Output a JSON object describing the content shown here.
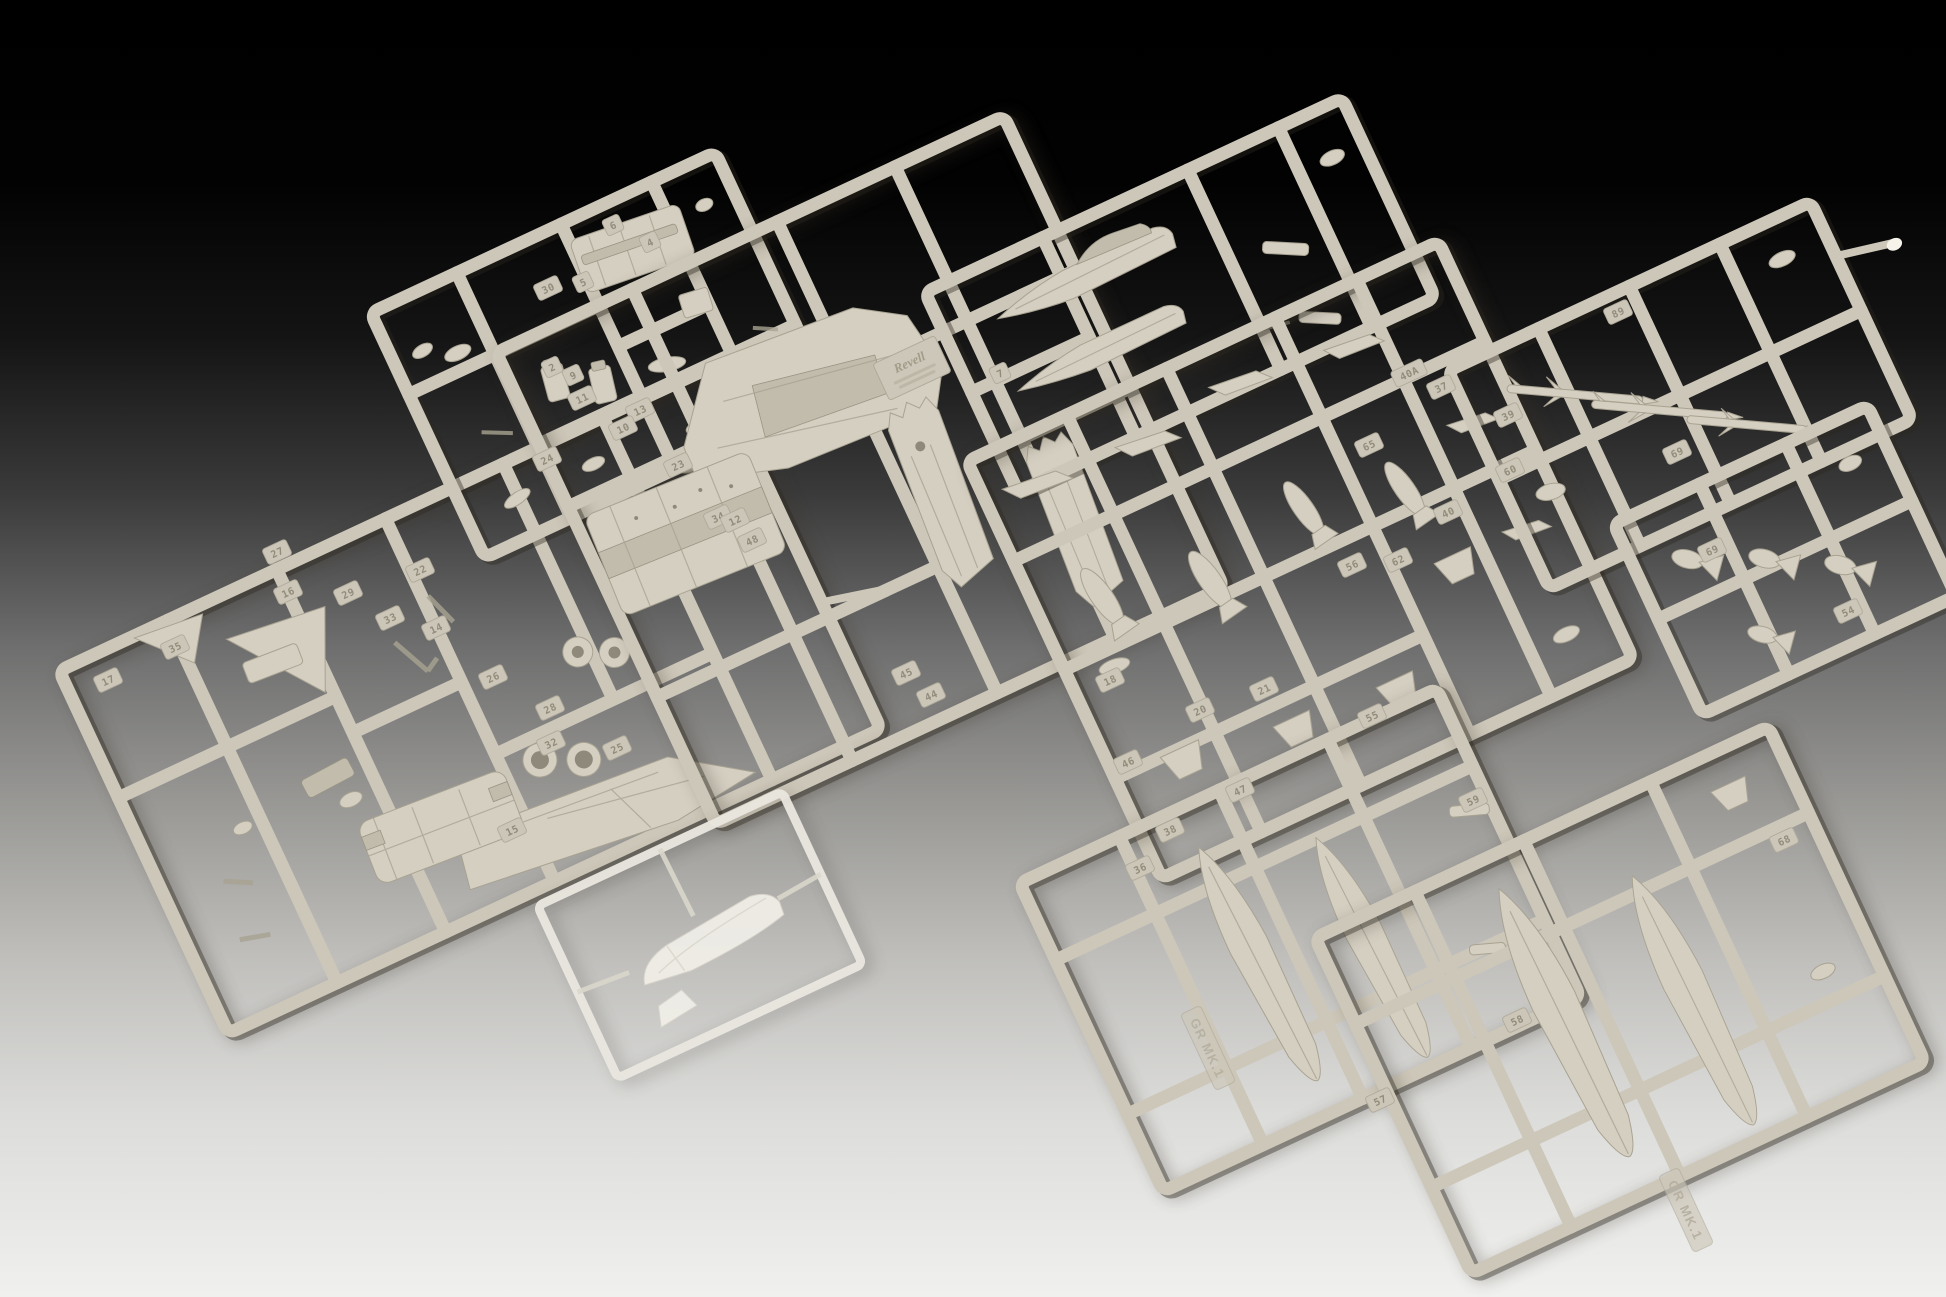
{
  "image": {
    "type": "product-photograph",
    "subject": "Unassembled plastic scale-model aircraft kit (Panavia Tornado GR Mk.1): nine light-grey injection-moulded sprues of parts plus one clear sprue with canopy parts, laid overlapping on a studio backdrop that fades from black at the top to pale grey at the bottom"
  },
  "colors": {
    "backdrop_top": "#000000",
    "backdrop_middle": "#6f6f6f",
    "backdrop_bottom": "#f0f0ee",
    "plastic_base": "#cdc7b9",
    "plastic_light": "#ddd8cb",
    "plastic_shadow": "#a8a291",
    "clear_plastic": "#f1efe8"
  },
  "branding": {
    "maker_plate": "Revell",
    "variant_marking": "GR MK.1"
  },
  "sprues": [
    {
      "id": "S1",
      "name": "cockpit-and-detail-parts",
      "contents": "cockpit tub, ejection seats, instrument panel, small interior parts"
    },
    {
      "id": "S2",
      "name": "airframe-parts",
      "contents": "delta wing panel, tailplane, vertical tail fin, twin exhaust nozzles, lower front fuselage, wheels, landing-gear struts, intake ramps"
    },
    {
      "id": "S3",
      "name": "fuselage-and-wing-panels",
      "contents": "upper wing panel, lower centre fuselage, two swing-wing panels, moulded Revell plate"
    },
    {
      "id": "S4",
      "name": "front-fuselage-halves",
      "contents": "two nose / front-fuselage halves, pylons, pitot probe"
    },
    {
      "id": "S5",
      "name": "weapons-and-pylons",
      "contents": "bombs, stores pylons, tail-fin units"
    },
    {
      "id": "S6",
      "name": "missiles",
      "contents": "air-to-air missiles, sprue pour stub with bright cut"
    },
    {
      "id": "S7",
      "name": "small-stores",
      "contents": "practice bombs with triangular fins"
    },
    {
      "id": "S8",
      "name": "drop-tanks-small",
      "contents": "two underwing drop tanks, GR MK.1 moulded on rail"
    },
    {
      "id": "S9",
      "name": "drop-tanks-large",
      "contents": "two large drop tanks, GR MK.1 moulded on rail"
    },
    {
      "id": "S10",
      "name": "clear-parts",
      "contents": "canopy and windscreen on clear sprue"
    }
  ],
  "part_labels": [
    {
      "text": "6",
      "x": 613,
      "y": 225,
      "r": -25
    },
    {
      "text": "4",
      "x": 650,
      "y": 242,
      "r": -25
    },
    {
      "text": "30",
      "x": 548,
      "y": 288,
      "r": -25
    },
    {
      "text": "5",
      "x": 583,
      "y": 282,
      "r": -25
    },
    {
      "text": "2",
      "x": 552,
      "y": 367,
      "r": -25
    },
    {
      "text": "9",
      "x": 573,
      "y": 375,
      "r": -25
    },
    {
      "text": "11",
      "x": 582,
      "y": 398,
      "r": -25
    },
    {
      "text": "13",
      "x": 640,
      "y": 410,
      "r": -25
    },
    {
      "text": "10",
      "x": 623,
      "y": 428,
      "r": -25
    },
    {
      "text": "24",
      "x": 547,
      "y": 459,
      "r": -25
    },
    {
      "text": "23",
      "x": 678,
      "y": 465,
      "r": -25
    },
    {
      "text": "34",
      "x": 718,
      "y": 517,
      "r": -25
    },
    {
      "text": "27",
      "x": 277,
      "y": 552,
      "r": -25
    },
    {
      "text": "16",
      "x": 288,
      "y": 592,
      "r": -25
    },
    {
      "text": "29",
      "x": 348,
      "y": 593,
      "r": -25
    },
    {
      "text": "33",
      "x": 390,
      "y": 618,
      "r": -25
    },
    {
      "text": "35",
      "x": 175,
      "y": 647,
      "r": -25
    },
    {
      "text": "17",
      "x": 108,
      "y": 680,
      "r": -25
    },
    {
      "text": "22",
      "x": 420,
      "y": 570,
      "r": -25
    },
    {
      "text": "14",
      "x": 436,
      "y": 628,
      "r": -25
    },
    {
      "text": "26",
      "x": 493,
      "y": 677,
      "r": -25
    },
    {
      "text": "28",
      "x": 550,
      "y": 708,
      "r": -25
    },
    {
      "text": "32",
      "x": 551,
      "y": 743,
      "r": -25
    },
    {
      "text": "25",
      "x": 617,
      "y": 748,
      "r": -25
    },
    {
      "text": "15",
      "x": 512,
      "y": 830,
      "r": -25
    },
    {
      "text": "7",
      "x": 1000,
      "y": 373,
      "r": -25
    },
    {
      "text": "12",
      "x": 735,
      "y": 520,
      "r": -25
    },
    {
      "text": "48",
      "x": 752,
      "y": 540,
      "r": -25
    },
    {
      "text": "45",
      "x": 906,
      "y": 673,
      "r": -25
    },
    {
      "text": "44",
      "x": 931,
      "y": 695,
      "r": -25
    },
    {
      "text": "40A",
      "x": 1409,
      "y": 373,
      "r": -25
    },
    {
      "text": "37",
      "x": 1441,
      "y": 387,
      "r": -25
    },
    {
      "text": "39",
      "x": 1508,
      "y": 415,
      "r": -25
    },
    {
      "text": "65",
      "x": 1369,
      "y": 445,
      "r": -25
    },
    {
      "text": "60",
      "x": 1510,
      "y": 470,
      "r": -25
    },
    {
      "text": "40",
      "x": 1448,
      "y": 512,
      "r": -25
    },
    {
      "text": "62",
      "x": 1398,
      "y": 560,
      "r": -25
    },
    {
      "text": "56",
      "x": 1352,
      "y": 565,
      "r": -25
    },
    {
      "text": "18",
      "x": 1110,
      "y": 680,
      "r": -25
    },
    {
      "text": "21",
      "x": 1264,
      "y": 689,
      "r": -25
    },
    {
      "text": "20",
      "x": 1200,
      "y": 710,
      "r": -25
    },
    {
      "text": "46",
      "x": 1128,
      "y": 762,
      "r": -25
    },
    {
      "text": "47",
      "x": 1240,
      "y": 790,
      "r": -25
    },
    {
      "text": "38",
      "x": 1170,
      "y": 830,
      "r": -25
    },
    {
      "text": "36",
      "x": 1140,
      "y": 868,
      "r": -25
    },
    {
      "text": "89",
      "x": 1618,
      "y": 312,
      "r": -25
    },
    {
      "text": "69",
      "x": 1677,
      "y": 452,
      "r": -25
    },
    {
      "text": "69",
      "x": 1712,
      "y": 550,
      "r": -25
    },
    {
      "text": "54",
      "x": 1848,
      "y": 611,
      "r": -25
    },
    {
      "text": "55",
      "x": 1372,
      "y": 716,
      "r": -25
    },
    {
      "text": "59",
      "x": 1473,
      "y": 800,
      "r": -25
    },
    {
      "text": "57",
      "x": 1380,
      "y": 1100,
      "r": -25
    },
    {
      "text": "58",
      "x": 1517,
      "y": 1020,
      "r": -25
    },
    {
      "text": "68",
      "x": 1784,
      "y": 840,
      "r": -25
    }
  ],
  "molded_texts": [
    {
      "text": "Revell",
      "x": 912,
      "y": 368,
      "r": -25,
      "style": "plate"
    },
    {
      "text": "GR MK.1",
      "x": 1208,
      "y": 1048,
      "r": 65,
      "style": "molded"
    },
    {
      "text": "GR MK.1",
      "x": 1686,
      "y": 1210,
      "r": 65,
      "style": "molded"
    }
  ]
}
